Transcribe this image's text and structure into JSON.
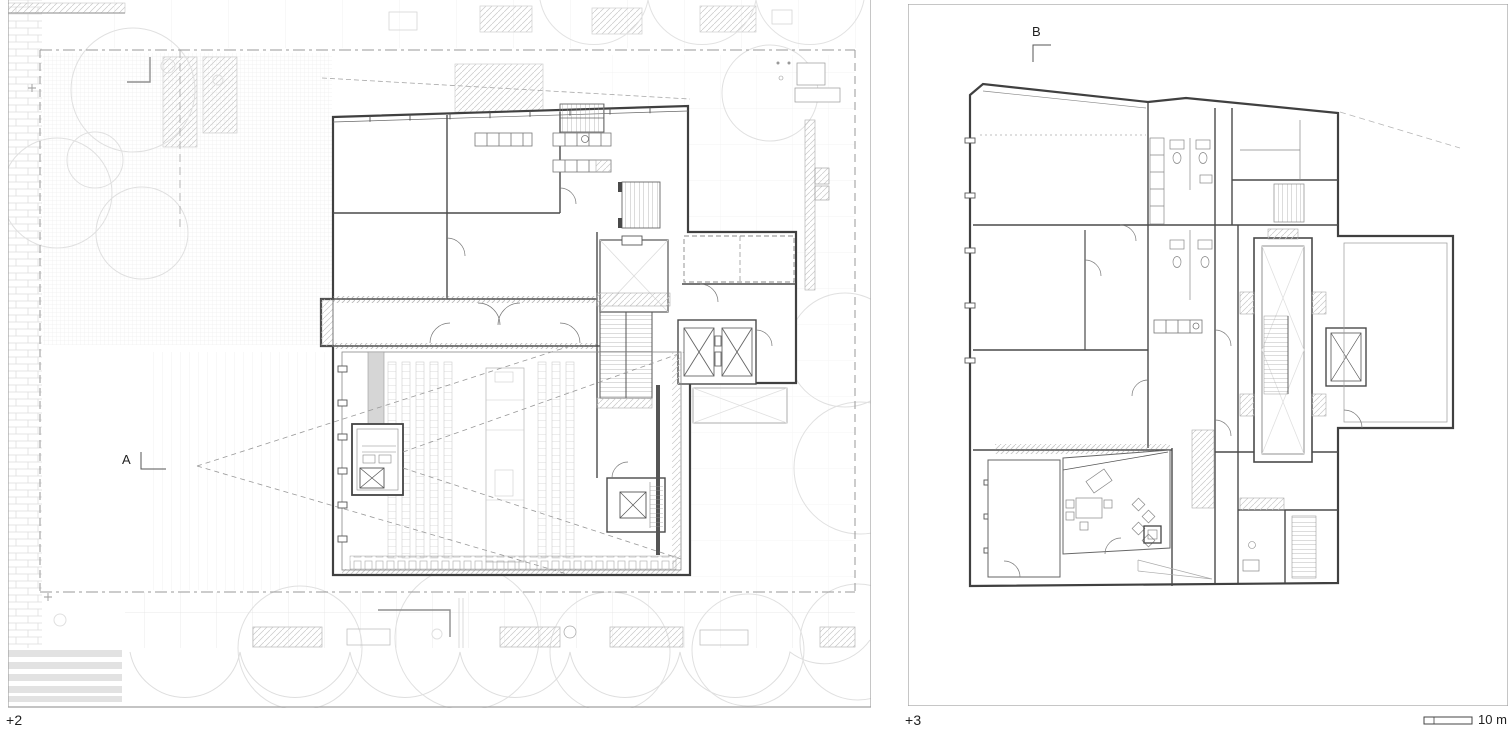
{
  "sheet": {
    "title": "architectural floor plan sheet",
    "plans": [
      {
        "name": "floor-plan-level-2",
        "level_label": "+2",
        "section_marker": "A"
      },
      {
        "name": "floor-plan-level-3",
        "level_label": "+3",
        "section_marker": "B"
      }
    ],
    "scale_bar": {
      "label": "10 m"
    }
  },
  "colors": {
    "background": "#ffffff",
    "wall": "#404040",
    "interior_wall": "#4a4a4a",
    "site_line": "#dedede",
    "dashed_boundary": "#999999",
    "panel_border": "#a0a0a0",
    "label_text": "#1f1f1f"
  }
}
